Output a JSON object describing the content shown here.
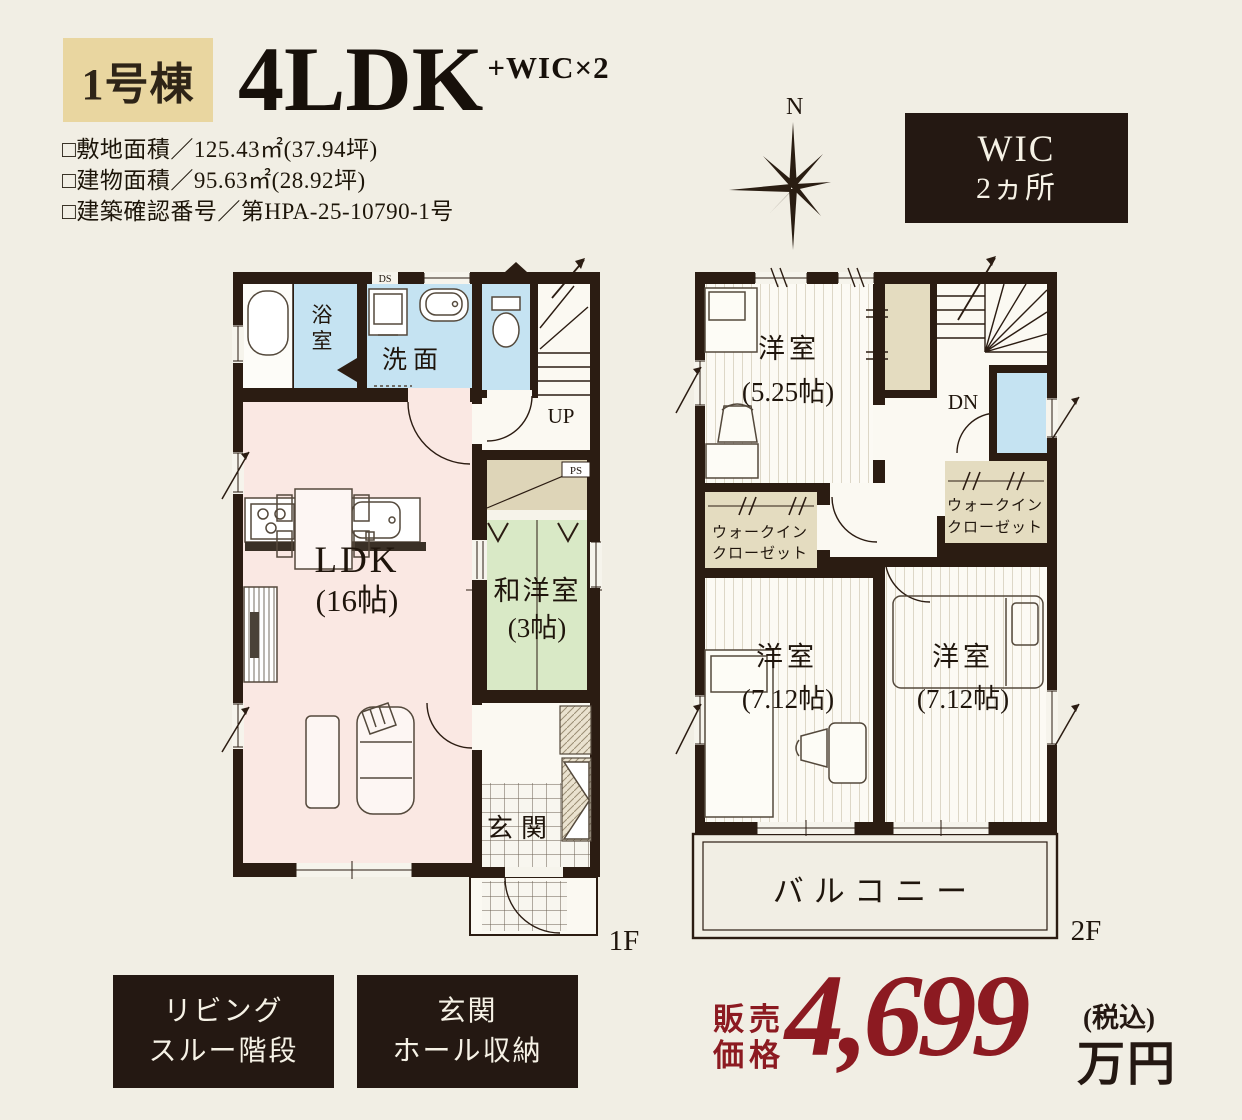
{
  "header": {
    "badge": "1号棟",
    "title": "4LDK",
    "title_suffix": "+WIC×2",
    "details": [
      "□敷地面積／125.43㎡(37.94坪)",
      "□建物面積／95.63㎡(28.92坪)",
      "□建築確認番号／第HPA-25-10790-1号"
    ],
    "compass_n": "N",
    "wic_box": {
      "line1": "WIC",
      "line2": "2ヵ所"
    }
  },
  "floor1": {
    "floor_label": "1F",
    "rooms": {
      "bath": "浴室",
      "washroom": "洗面",
      "ldk": "LDK",
      "ldk_size": "(16帖)",
      "japanese_room": "和洋室",
      "japanese_room_size": "(3帖)",
      "entrance": "玄関",
      "stairs_up": "UP",
      "duct": "DS",
      "pipe_space": "PS"
    }
  },
  "floor2": {
    "floor_label": "2F",
    "rooms": {
      "bedroom1": "洋室",
      "bedroom1_size": "(5.25帖)",
      "bedroom2": "洋室",
      "bedroom2_size": "(7.12帖)",
      "bedroom3": "洋室",
      "bedroom3_size": "(7.12帖)",
      "wic1_line1": "ウォークイン",
      "wic1_line2": "クローゼット",
      "wic2_line1": "ウォークイン",
      "wic2_line2": "クローゼット",
      "balcony": "バルコニー",
      "stairs_down": "DN"
    }
  },
  "features": [
    {
      "line1": "リビング",
      "line2": "スルー階段"
    },
    {
      "line1": "玄関",
      "line2": "ホール収納"
    }
  ],
  "price": {
    "label_line1": "販売",
    "label_line2": "価格",
    "amount": "4,699",
    "tax_note": "(税込)",
    "unit": "万円"
  },
  "colors": {
    "accent_red": "#8c1a21",
    "wall_dark": "#2b1c12",
    "badge_gold": "#e9d6a0",
    "box_dark": "#241812",
    "room_blue": "#c5e3f2",
    "room_pink": "#fae8e3",
    "room_green": "#d9e9c6",
    "closet_tan": "#e4dcc0"
  }
}
